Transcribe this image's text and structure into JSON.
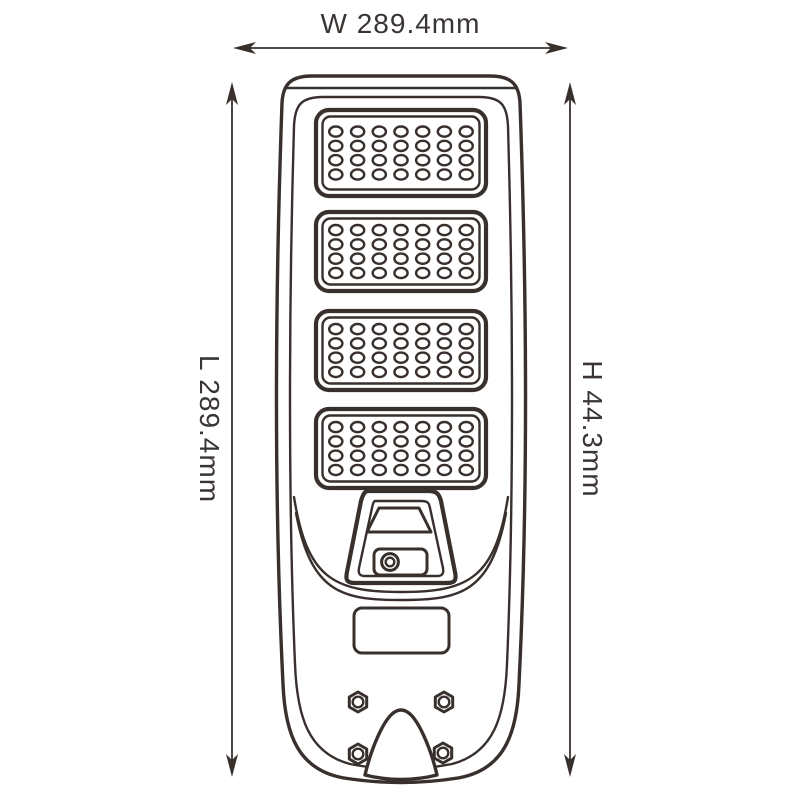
{
  "page": {
    "background": "#ffffff",
    "line_color": "#38302d",
    "text_color": "#3a3533"
  },
  "dimension_labels": {
    "width": "W 289.4mm",
    "length": "L 289.4mm",
    "height": "H 44.3mm"
  },
  "device": {
    "led_panels": {
      "count": 4,
      "led_columns": 7,
      "led_rows": 4
    },
    "mounting_screws": {
      "count": 4
    },
    "sensor_camera": {
      "present": true
    },
    "label_plate": {
      "present": true
    }
  }
}
